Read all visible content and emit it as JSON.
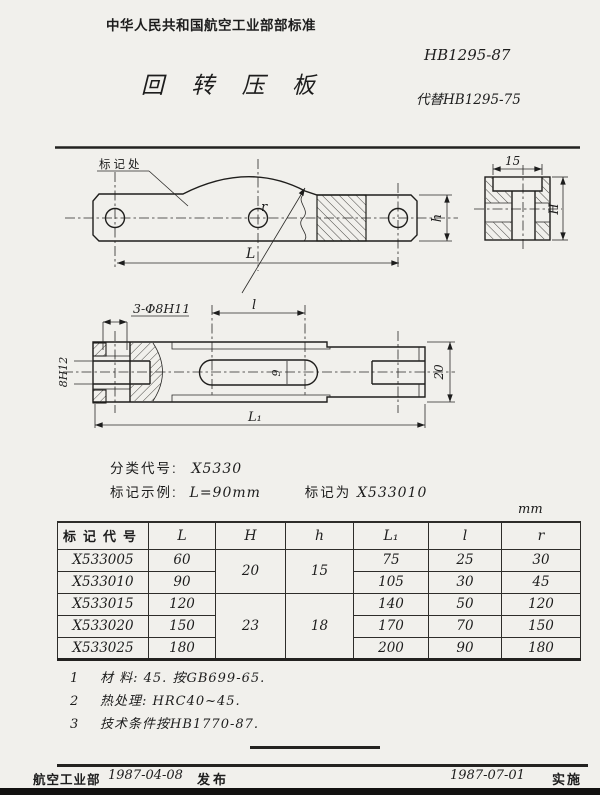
{
  "header": {
    "org_standard": "中华人民共和国航空工业部部标准",
    "standard_no": "HB1295-87",
    "title": "回 转 压 板",
    "replaces": "代替HB1295-75"
  },
  "drawing": {
    "front_view": {
      "mark_label": "标记处",
      "r_label": "r",
      "L_label": "L",
      "h_label": "h"
    },
    "end_view": {
      "width_label": "15",
      "H_label": "H"
    },
    "top_view": {
      "holes_label": "3-Φ8H11",
      "l_label": "l",
      "slot_width_label": "9",
      "fork_slot_label": "8H12",
      "width_label": "20",
      "L1_label": "L₁"
    }
  },
  "classification": {
    "code_label": "分类代号:",
    "code_value": "X5330",
    "example_label": "标记示例:",
    "example_condition": "L=90mm",
    "designation_label": "标记为",
    "designation_value": "X533010"
  },
  "table": {
    "unit": "mm",
    "headers": [
      "标记代号",
      "L",
      "H",
      "h",
      "L₁",
      "l",
      "r"
    ],
    "rows": [
      [
        "X533005",
        "60",
        "75",
        "25",
        "30"
      ],
      [
        "X533010",
        "90",
        "105",
        "30",
        "45"
      ],
      [
        "X533015",
        "120",
        "140",
        "50",
        "120"
      ],
      [
        "X533020",
        "150",
        "170",
        "70",
        "150"
      ],
      [
        "X533025",
        "180",
        "200",
        "90",
        "180"
      ]
    ],
    "H_merged": [
      "20",
      "23"
    ],
    "h_merged": [
      "15",
      "18"
    ]
  },
  "notes": {
    "n1_no": "1",
    "n1": "材  料: 45. 按GB699-65.",
    "n2_no": "2",
    "n2": "热处理: HRC40~45.",
    "n3_no": "3",
    "n3": "技术条件按HB1770-87."
  },
  "footer": {
    "issuer": "航空工业部",
    "issue_date": "1987-04-08",
    "issue_label": "发布",
    "implement_date": "1987-07-01",
    "implement_label": "实施"
  }
}
